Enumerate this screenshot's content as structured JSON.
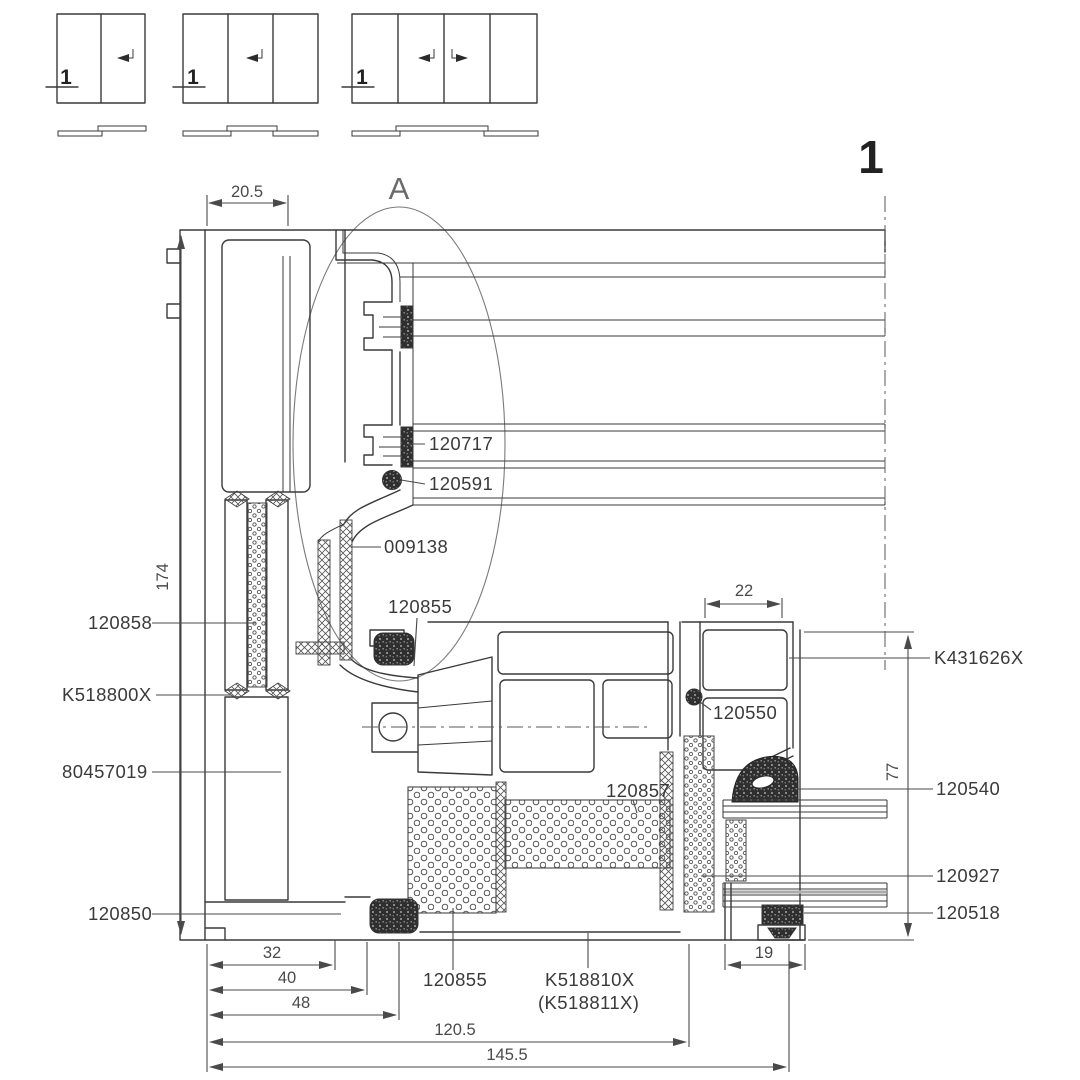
{
  "colors": {
    "line": "#3a3a3a",
    "dim": "#4a4a4a",
    "background": "#ffffff"
  },
  "sheet": {
    "number": "1",
    "detail_marker": "A"
  },
  "schematics": {
    "items": [
      {
        "panels": 2,
        "cut_label": "1"
      },
      {
        "panels": 3,
        "cut_label": "1"
      },
      {
        "panels": 4,
        "cut_label": "1"
      }
    ]
  },
  "section": {
    "part_labels": {
      "p120717": "120717",
      "p120591": "120591",
      "p009138": "009138",
      "p120855_top": "120855",
      "p120858": "120858",
      "pK518800X": "K518800X",
      "p80457019": "80457019",
      "p120850": "120850",
      "p120857": "120857",
      "pK431626X": "K431626X",
      "p120550": "120550",
      "p120540": "120540",
      "p120927": "120927",
      "p120518": "120518",
      "p120855_bottom": "120855",
      "pK518810X": "K518810X",
      "pK518811X": "(K518811X)"
    },
    "dimensions": {
      "d20_5": "20.5",
      "d174": "174",
      "d22": "22",
      "d77": "77",
      "d32": "32",
      "d40": "40",
      "d48": "48",
      "d120_5": "120.5",
      "d145_5": "145.5",
      "d19": "19"
    }
  }
}
